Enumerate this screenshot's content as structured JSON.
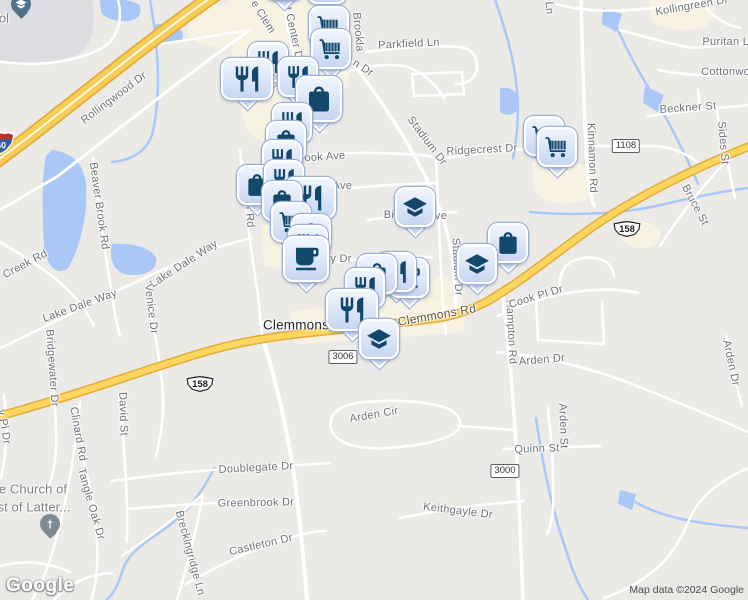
{
  "attribution": {
    "logo": "Google",
    "map_data": "Map data ©2024 Google"
  },
  "colors": {
    "land": "#ebeae6",
    "road": "#ffffff",
    "highway_fill": "#fcd65f",
    "highway_edge": "#e3ab3b",
    "interstate_fill": "#f7cf58",
    "water": "#a9c7f7",
    "commercial_area": "#f8f2e2",
    "building_area": "#dbdde0",
    "marker_glyph": "#11486b",
    "marker_face": "#dbe5f8",
    "church_pin": "#7e8a93",
    "school_pin": "#53708a"
  },
  "city_labels": [
    {
      "text": "Clemmons",
      "x": 296,
      "y": 325,
      "rot": 0
    }
  ],
  "poi_labels": [
    {
      "text": "e Church of",
      "x": 33,
      "y": 489,
      "rot": 0
    },
    {
      "text": "st of Latter...",
      "x": 34,
      "y": 507,
      "rot": 0
    },
    {
      "text": "ol",
      "x": 4,
      "y": 18,
      "rot": 0
    }
  ],
  "highway_labels": [
    {
      "text": "Clemmons Rd",
      "x": 437,
      "y": 315,
      "rot": -10
    }
  ],
  "road_labels": [
    {
      "text": "Rollingwood Dr",
      "x": 114,
      "y": 98,
      "rot": -37
    },
    {
      "text": "e Clem",
      "x": 263,
      "y": 17,
      "rot": 58
    },
    {
      "text": "et Center Dr",
      "x": 293,
      "y": 32,
      "rot": 78
    },
    {
      "text": "Brookla",
      "x": 358,
      "y": 32,
      "rot": 85
    },
    {
      "text": "n Dr",
      "x": 363,
      "y": 68,
      "rot": 33
    },
    {
      "text": "Parkfield Ln",
      "x": 409,
      "y": 44,
      "rot": -3
    },
    {
      "text": "Kollingreen Dr",
      "x": 692,
      "y": 6,
      "rot": -10
    },
    {
      "text": "Ln",
      "x": 549,
      "y": 8,
      "rot": 85
    },
    {
      "text": "Puritan Ln",
      "x": 729,
      "y": 42,
      "rot": 0
    },
    {
      "text": "Cottonwood",
      "x": 732,
      "y": 72,
      "rot": 0
    },
    {
      "text": "Beckner St",
      "x": 688,
      "y": 108,
      "rot": -4
    },
    {
      "text": "Sides St",
      "x": 723,
      "y": 143,
      "rot": 85
    },
    {
      "text": "Kinnamon Rd",
      "x": 592,
      "y": 158,
      "rot": 88
    },
    {
      "text": "Bruce St",
      "x": 695,
      "y": 205,
      "rot": 62
    },
    {
      "text": "Stadium Dr",
      "x": 427,
      "y": 141,
      "rot": 53
    },
    {
      "text": "Ridgecrest Dr",
      "x": 482,
      "y": 150,
      "rot": -3
    },
    {
      "text": "ook Ave",
      "x": 325,
      "y": 157,
      "rot": -4
    },
    {
      "text": "r Ave",
      "x": 339,
      "y": 186,
      "rot": 0
    },
    {
      "text": "Bi",
      "x": 389,
      "y": 215,
      "rot": 0
    },
    {
      "text": "ve",
      "x": 441,
      "y": 216,
      "rot": 0
    },
    {
      "text": "orf Rd",
      "x": 249,
      "y": 212,
      "rot": 85
    },
    {
      "text": "y Dr",
      "x": 341,
      "y": 259,
      "rot": 0
    },
    {
      "text": "Stadium Dr",
      "x": 457,
      "y": 267,
      "rot": 87
    },
    {
      "text": "Hampton Rd",
      "x": 511,
      "y": 332,
      "rot": 87
    },
    {
      "text": "Cook Pl Dr",
      "x": 536,
      "y": 297,
      "rot": -17
    },
    {
      "text": "Arden Dr",
      "x": 542,
      "y": 360,
      "rot": -5
    },
    {
      "text": "Arden Dr",
      "x": 731,
      "y": 363,
      "rot": 78
    },
    {
      "text": "Arden Cir",
      "x": 374,
      "y": 415,
      "rot": -10
    },
    {
      "text": "Arden St",
      "x": 563,
      "y": 426,
      "rot": 88
    },
    {
      "text": "Quinn St",
      "x": 537,
      "y": 449,
      "rot": -2
    },
    {
      "text": "Keithgayle Dr",
      "x": 458,
      "y": 511,
      "rot": 7
    },
    {
      "text": "Doublegate Dr",
      "x": 256,
      "y": 468,
      "rot": -3
    },
    {
      "text": "Greenbrook Dr",
      "x": 256,
      "y": 503,
      "rot": -1
    },
    {
      "text": "Castleton Dr",
      "x": 261,
      "y": 545,
      "rot": -13
    },
    {
      "text": "Breckingridge Ln",
      "x": 190,
      "y": 553,
      "rot": 75
    },
    {
      "text": "Lake Dale Way",
      "x": 80,
      "y": 306,
      "rot": -20
    },
    {
      "text": "Lake Dale Way",
      "x": 184,
      "y": 264,
      "rot": -33
    },
    {
      "text": "Venice Dr",
      "x": 151,
      "y": 309,
      "rot": 83
    },
    {
      "text": "Beaver Brook Rd",
      "x": 99,
      "y": 206,
      "rot": 82
    },
    {
      "text": "Bridgewater Dr",
      "x": 52,
      "y": 368,
      "rot": 86
    },
    {
      "text": "r Creek Rd",
      "x": 22,
      "y": 266,
      "rot": -28
    },
    {
      "text": "y Pl Dr",
      "x": 4,
      "y": 427,
      "rot": 80
    },
    {
      "text": "Clinard Rd",
      "x": 78,
      "y": 434,
      "rot": 80
    },
    {
      "text": "David St",
      "x": 123,
      "y": 414,
      "rot": 88
    },
    {
      "text": "Tangle Oak Dr",
      "x": 91,
      "y": 504,
      "rot": 74
    }
  ],
  "route_badges": [
    {
      "style": "interstate",
      "text": "40",
      "x": 1,
      "y": 143
    },
    {
      "style": "us-shield",
      "text": "158",
      "x": 200,
      "y": 361
    },
    {
      "style": "us-shield",
      "text": "158",
      "x": 627,
      "y": 190
    },
    {
      "style": "rect",
      "text": "1108",
      "x": 626,
      "y": 146
    },
    {
      "style": "rect",
      "text": "3006",
      "x": 343,
      "y": 357
    },
    {
      "style": "rect",
      "text": "3000",
      "x": 505,
      "y": 471
    }
  ],
  "markers": [
    {
      "type": "cart",
      "x": 327,
      "y": -16
    },
    {
      "type": "restaurant",
      "x": 284,
      "y": -20
    },
    {
      "type": "cart",
      "x": 329,
      "y": 26
    },
    {
      "type": "cart",
      "x": 331,
      "y": 49
    },
    {
      "type": "restaurant",
      "x": 268,
      "y": 62
    },
    {
      "type": "restaurant",
      "x": 247,
      "y": 79,
      "wide": true
    },
    {
      "type": "restaurant",
      "x": 298,
      "y": 77
    },
    {
      "type": "bag",
      "x": 319,
      "y": 99,
      "big": true
    },
    {
      "type": "restaurant",
      "x": 292,
      "y": 123
    },
    {
      "type": "bag",
      "x": 286,
      "y": 141
    },
    {
      "type": "restaurant",
      "x": 282,
      "y": 160
    },
    {
      "type": "bag",
      "x": 257,
      "y": 185
    },
    {
      "type": "restaurant",
      "x": 284,
      "y": 180
    },
    {
      "type": "restaurant",
      "x": 310,
      "y": 198,
      "wide": true
    },
    {
      "type": "bag",
      "x": 282,
      "y": 201
    },
    {
      "type": "cart",
      "x": 291,
      "y": 222
    },
    {
      "type": "bag",
      "x": 311,
      "y": 234
    },
    {
      "type": "restaurant",
      "x": 308,
      "y": 245
    },
    {
      "type": "coffee",
      "x": 306,
      "y": 259,
      "big": true
    },
    {
      "type": "coffee",
      "x": 409,
      "y": 278
    },
    {
      "type": "restaurant",
      "x": 396,
      "y": 272
    },
    {
      "type": "bag",
      "x": 377,
      "y": 274
    },
    {
      "type": "restaurant",
      "x": 365,
      "y": 288
    },
    {
      "type": "restaurant",
      "x": 352,
      "y": 310,
      "wide": true
    },
    {
      "type": "school",
      "x": 379,
      "y": 339
    },
    {
      "type": "school",
      "x": 415,
      "y": 207
    },
    {
      "type": "bag",
      "x": 508,
      "y": 243
    },
    {
      "type": "school",
      "x": 477,
      "y": 264
    },
    {
      "type": "cart",
      "x": 544,
      "y": 136
    },
    {
      "type": "cart",
      "x": 557,
      "y": 147
    },
    {
      "type": "school-pin",
      "x": 21,
      "y": 4
    },
    {
      "type": "church-pin",
      "x": 50,
      "y": 524
    }
  ]
}
